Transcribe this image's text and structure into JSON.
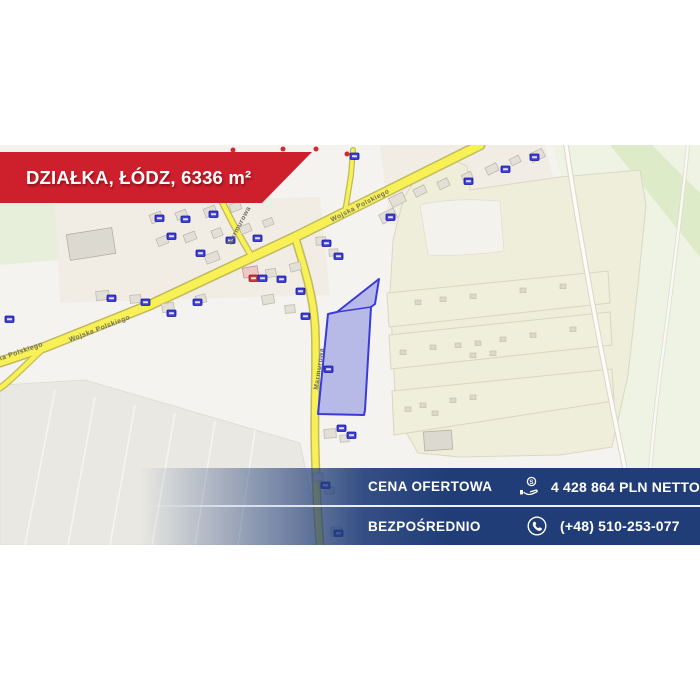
{
  "listing": {
    "title": "DZIAŁKA, ŁÓDZ, 6336 m²"
  },
  "top_banner": {
    "bg_color": "#ce1f2d",
    "text_color": "#ffffff"
  },
  "offer_panel": {
    "panel_color": "#203d78",
    "divider_color": "#ebf2fc",
    "rows": [
      {
        "label": "CENA OFERTOWA",
        "icon": "coins-in-hand-icon",
        "value": "4 428 864 PLN NETTO"
      },
      {
        "label": "BEZPOŚREDNIO",
        "icon": "phone-icon",
        "value": "(+48) 510-253-077"
      }
    ]
  },
  "map": {
    "street_labels": [
      "Wojska Polskiego",
      "Wojska Polskiego",
      "Wojska Polskiego",
      "Marmurowa",
      "Marmurowa"
    ],
    "plot": {
      "fill_color": "#7a81e0",
      "stroke_color": "#3a3ad8"
    },
    "colors": {
      "road_fill": "#f8f155",
      "road_casing": "#c0b95e",
      "farmland": "#efeeda",
      "greenfield": "#e4eecf",
      "gray_field": "#e9e8e2",
      "building": "#e2dfd6",
      "address_plate": "#4040d4",
      "poi_dot": "#d12c2c"
    }
  }
}
